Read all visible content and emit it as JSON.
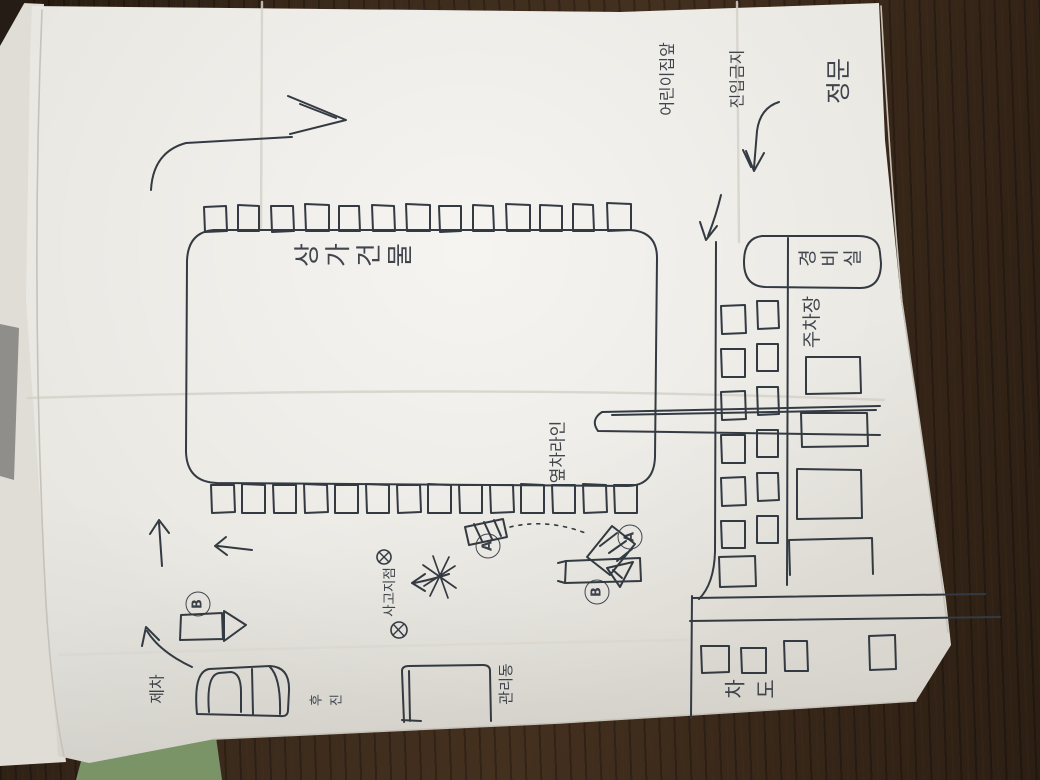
{
  "sketch": {
    "labels": {
      "building": "상가건물",
      "side_parking_line": "옆차라인",
      "accident_point": "사고지점",
      "my_car": "제차",
      "reversing": "후진",
      "management_building": "관리동",
      "main_gate": "정문",
      "notice_line1": "어린이집앞",
      "notice_line2": "진입금지",
      "security_office": "경비실",
      "parking_lot": "주차장",
      "roadway": "차도",
      "vehicle_a": "A",
      "vehicle_b": "B"
    },
    "colors": {
      "ink": "#333a42",
      "paper": "#e9e7e1",
      "wood": "#3a2a1c",
      "under_sheet": "#e0ddd6",
      "gray_object": "#8f8e8a",
      "green_object": "#7a9468"
    }
  }
}
